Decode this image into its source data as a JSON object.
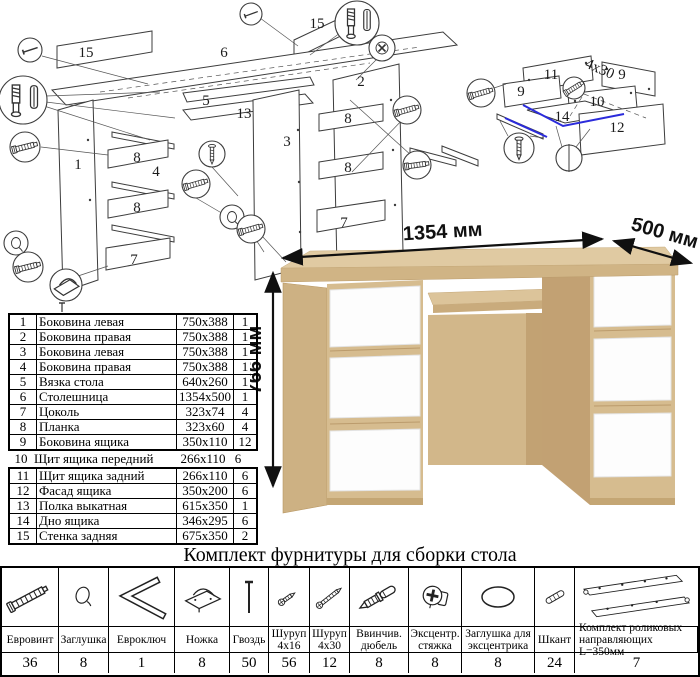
{
  "colors": {
    "highlight_blue": "#2b2bdb",
    "wood": "#d6bc8f",
    "wood_top": "#e0caa2",
    "drawer_white": "#fdfdfd"
  },
  "diagram_labels": {
    "main": [
      "15",
      "6",
      "15",
      "5",
      "13",
      "3",
      "2",
      "1",
      "8",
      "4",
      "8",
      "7",
      "8",
      "8",
      "7"
    ],
    "drawer": [
      "11",
      "9",
      "9",
      "10",
      "14",
      "12"
    ],
    "screw_note": "4x30"
  },
  "desk": {
    "width_label": "1354 мм",
    "depth_label": "500 мм",
    "height_label": "766 мм"
  },
  "parts": {
    "rows_top": [
      {
        "num": "1",
        "name": "Боковина левая",
        "size": "750x388",
        "qty": "1"
      },
      {
        "num": "2",
        "name": "Боковина правая",
        "size": "750x388",
        "qty": "1"
      },
      {
        "num": "3",
        "name": "Боковина левая",
        "size": "750x388",
        "qty": "1"
      },
      {
        "num": "4",
        "name": "Боковина правая",
        "size": "750x388",
        "qty": "1"
      },
      {
        "num": "5",
        "name": "Вязка стола",
        "size": "640x260",
        "qty": "1"
      },
      {
        "num": "6",
        "name": "Столешница",
        "size": "1354x500",
        "qty": "1"
      },
      {
        "num": "7",
        "name": "Цоколь",
        "size": "323x74",
        "qty": "4"
      },
      {
        "num": "8",
        "name": "Планка",
        "size": "323x60",
        "qty": "4"
      },
      {
        "num": "9",
        "name": "Боковина ящика",
        "size": "350x110",
        "qty": "12"
      }
    ],
    "row_mid": {
      "num": "10",
      "name": "Щит ящика передний",
      "size": "266x110",
      "qty": "6"
    },
    "rows_bottom": [
      {
        "num": "11",
        "name": "Щит ящика задний",
        "size": "266x110",
        "qty": "6"
      },
      {
        "num": "12",
        "name": "Фасад ящика",
        "size": "350x200",
        "qty": "6"
      },
      {
        "num": "13",
        "name": "Полка выкатная",
        "size": "615x350",
        "qty": "1"
      },
      {
        "num": "14",
        "name": "Дно ящика",
        "size": "346x295",
        "qty": "6"
      },
      {
        "num": "15",
        "name": "Стенка задняя",
        "size": "675x350",
        "qty": "2"
      }
    ]
  },
  "hardware": {
    "title": "Комплект фурнитуры для сборки стола",
    "items": [
      {
        "name": "Евровинт",
        "qty": "36",
        "icon": "confirmat-screw"
      },
      {
        "name": "Заглушка",
        "qty": "8",
        "icon": "cap"
      },
      {
        "name": "Евроключ",
        "qty": "1",
        "icon": "hex-key"
      },
      {
        "name": "Ножка",
        "qty": "8",
        "icon": "foot"
      },
      {
        "name": "Гвоздь",
        "qty": "50",
        "icon": "nail"
      },
      {
        "name": "Шуруп 4x16",
        "qty": "56",
        "icon": "screw-small"
      },
      {
        "name": "Шуруп 4x30",
        "qty": "12",
        "icon": "screw-long"
      },
      {
        "name": "Ввинчив. дюбель",
        "qty": "8",
        "icon": "threaded-dowel"
      },
      {
        "name": "Эксцентр. стяжка",
        "qty": "8",
        "icon": "cam-lock"
      },
      {
        "name": "Заглушка для эксцентрика",
        "qty": "8",
        "icon": "cam-cap"
      },
      {
        "name": "Шкант",
        "qty": "24",
        "icon": "wood-dowel"
      },
      {
        "name": "Комплект роликовых направляющих L=350мм",
        "qty": "7",
        "icon": "drawer-slides"
      }
    ]
  }
}
